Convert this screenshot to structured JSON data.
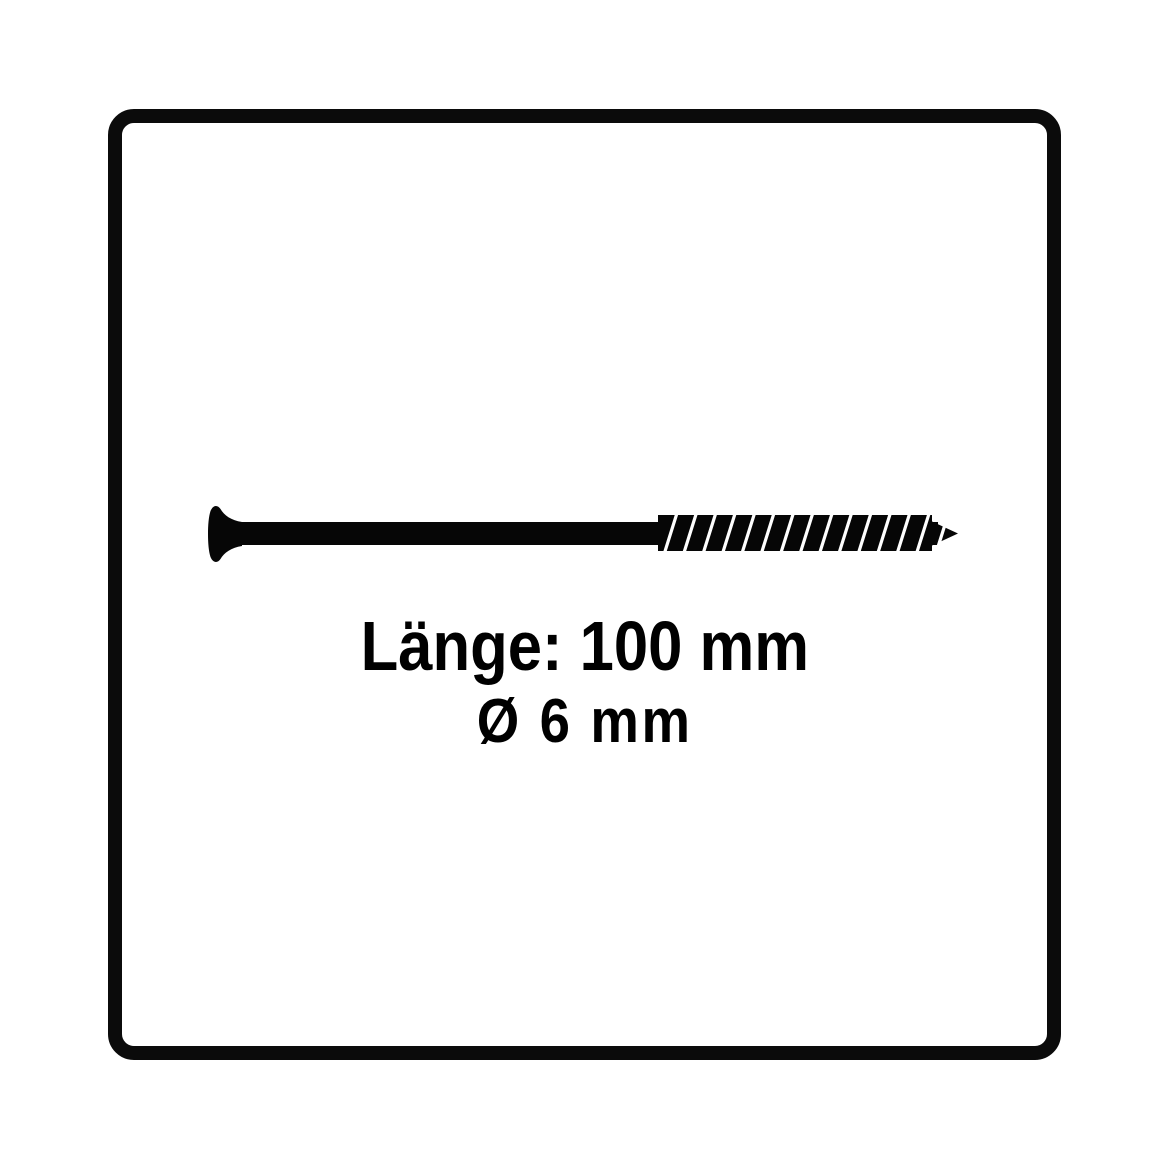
{
  "canvas": {
    "background_color": "#ffffff"
  },
  "frame": {
    "border_color": "#0b0b0b",
    "background_color": "#ffffff"
  },
  "illustration": {
    "name": "countersunk-wood-screw-side-view",
    "body_color": "#060606",
    "thread_highlight_color": "#ffffff"
  },
  "specs": {
    "length_label": "Länge: 100 mm",
    "diameter_label": "Ø 6 mm",
    "text_color": "#000000"
  }
}
